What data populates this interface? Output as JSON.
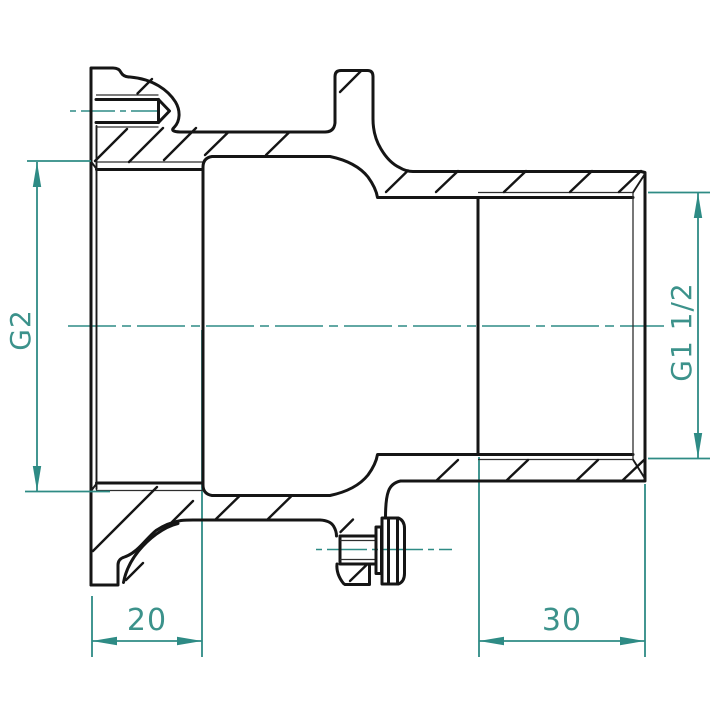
{
  "drawing": {
    "background": "#ffffff",
    "outline_color": "#151515",
    "dimension_color": "#2e8b85",
    "dimensions": {
      "left_thread_label": "G2",
      "right_thread_label": "G1 1/2",
      "left_depth_label": "20",
      "right_depth_label": "30"
    }
  }
}
